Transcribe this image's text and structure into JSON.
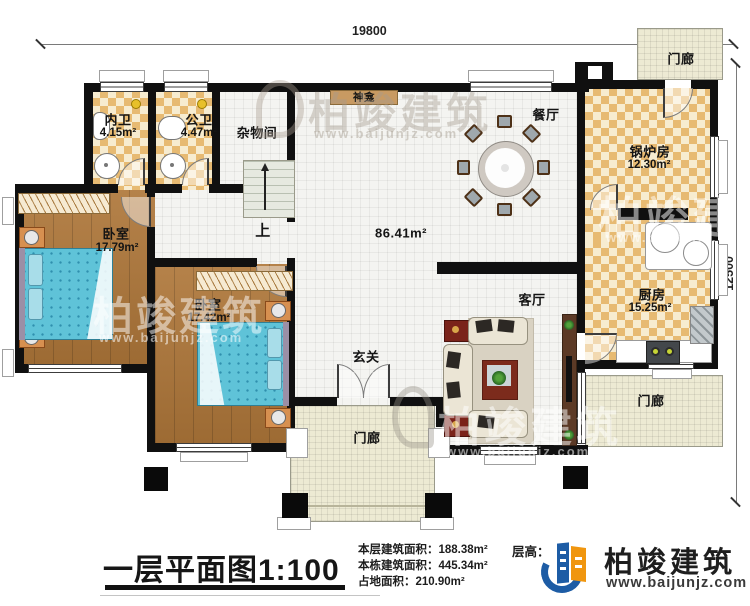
{
  "plan": {
    "dimensions": {
      "width_top": "19800",
      "height_right": "12500"
    },
    "rooms": {
      "bath_ensuite": {
        "name": "内卫",
        "area": "4.15m²"
      },
      "bath_public": {
        "name": "公卫",
        "area": "4.47m²"
      },
      "storage": {
        "name": "杂物间"
      },
      "bedroom_left": {
        "name": "卧室",
        "area": "17.79m²"
      },
      "bedroom_center": {
        "name": "卧室",
        "area": "17.42m²"
      },
      "hall": {
        "area": "86.41m²"
      },
      "dining": {
        "name": "餐厅"
      },
      "living": {
        "name": "客厅"
      },
      "foyer": {
        "name": "玄关"
      },
      "boiler": {
        "name": "锅炉房",
        "area": "12.30m²"
      },
      "kitchen": {
        "name": "厨房",
        "area": "15.25m²"
      },
      "porch_top": {
        "name": "门廊"
      },
      "porch_bottom": {
        "name": "门廊"
      },
      "porch_right": {
        "name": "门廊"
      },
      "shrine": {
        "name": "神龛"
      },
      "stairs": {
        "label": "上"
      }
    }
  },
  "watermark": {
    "brand": "柏竣建筑",
    "url": "www.baijunjz.com"
  },
  "title_block": {
    "title": "一层平面图",
    "scale": "1:100",
    "stats": [
      {
        "label": "本层建筑面积：",
        "value": "188.38m²"
      },
      {
        "label": "本栋建筑面积：",
        "value": "445.34m²"
      },
      {
        "label": "占地面积：",
        "value": "210.90m²"
      }
    ],
    "floor_height_label": "层高：",
    "brand": "柏竣建筑",
    "website": "www.baijunjz.com"
  },
  "colors": {
    "wall": "#101010",
    "checker": "#e7ba72",
    "wood": "#a9763d",
    "bed": "#5fc3d8",
    "brand_blue": "#1d5ca5",
    "brand_orange": "#f0960f"
  }
}
